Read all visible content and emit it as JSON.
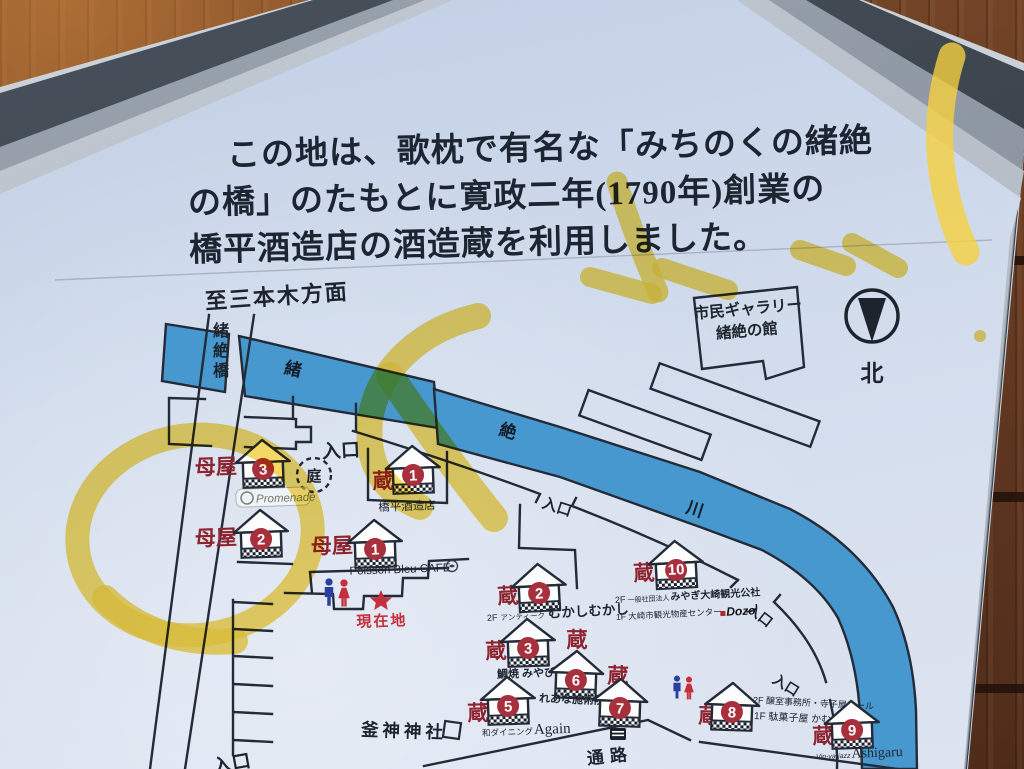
{
  "header": {
    "line1": "この地は、歌枕で有名な「みちのくの緒絶",
    "line2": "の橋」のたもとに寛政二年(1790年)創業の",
    "line3": "橋平酒造店の酒造蔵を利用しました。"
  },
  "map": {
    "direction": "至三本木方面",
    "bridge": {
      "c1": "緒",
      "c2": "絶",
      "c3": "橋"
    },
    "river": {
      "c1": "緒",
      "c2": "絶",
      "c3": "川"
    },
    "gallery": {
      "line1": "市民ギャラリー",
      "line2": "緒絶の館"
    },
    "north": "北",
    "garden": "庭",
    "entrance": "入口",
    "passage": "通路",
    "shrine": "釜神神社",
    "current_location": "現在地",
    "promenade": "Promenade",
    "houses": {
      "omoya_label": "母屋",
      "kura_label": "蔵",
      "omoya": [
        {
          "num": "1",
          "shop": "Poisson Bleu CAFE"
        },
        {
          "num": "2"
        },
        {
          "num": "3"
        }
      ],
      "kura": [
        {
          "num": "1",
          "shop": "橋平酒造店"
        },
        {
          "num": "2",
          "floor": "2F",
          "sub": "アンティーク",
          "shop": "むかしむかし"
        },
        {
          "num": "3",
          "shop": "鯛焼 みやび"
        },
        {
          "num": "5",
          "sub": "和ダイニング",
          "shop": "Again"
        },
        {
          "num": "6",
          "shop": "れあな施術院"
        },
        {
          "num": "7"
        },
        {
          "num": "8",
          "line1": "2F 醸室事務所・寺子屋ホール",
          "line2": "1F 駄菓子屋 かむろ"
        },
        {
          "num": "9",
          "sub": "Vin-ya-jazz",
          "shop": "Ashigaru"
        },
        {
          "num": "10",
          "line1_prefix": "2F",
          "line1_org": "一般社団法人",
          "line1_main": "みやぎ大崎観光公社",
          "line2": "1F 大崎市観光物産センター",
          "logo": "Dozo"
        }
      ]
    }
  },
  "colors": {
    "river_blue": "#4698cf",
    "accent_red": "#c5303c",
    "kura_red": "#8e2430",
    "circle_red": "#a8303c",
    "highlight_yellow": "#f5d040",
    "sign_bg": "#d2dcec",
    "frame_dark": "#39414a",
    "wood_brown": "#6d4024"
  }
}
